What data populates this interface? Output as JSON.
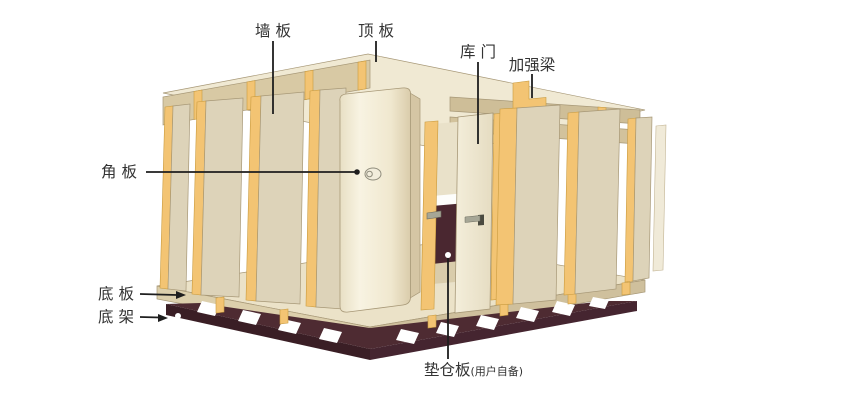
{
  "palette": {
    "background": "#ffffff",
    "panel_face": "#DDD3B9",
    "panel_face_light": "#EFE8D2",
    "panel_edge_yellow": "#F3C473",
    "panel_edge_yellow_dark": "#C99B3F",
    "roof_top": "#F0E9D3",
    "roof_fascia": "#D8C9A4",
    "roof_fascia_right": "#CEBE98",
    "header_rail": "#D2C29C",
    "panel_side_face": "#D5C6A4",
    "slab_top": "#EBE2C8",
    "slab_left_face": "#DCCFAC",
    "slab_right_face": "#CFC09D",
    "frame_dark": "#4E2B32",
    "frame_darker": "#3A1E25",
    "interior_dark": "#4A2730",
    "interior_wall": "#E9E1C9",
    "interior_trim": "#D9CCAB",
    "metal": "#A6A696",
    "leader_line": "#1E1E1E",
    "label_text": "#333333",
    "outline": "#A79877"
  },
  "labels": {
    "wall_panel": "墙 板",
    "top_panel": "顶 板",
    "door": "库 门",
    "reinforcement_beam": "加强梁",
    "corner_panel": "角 板",
    "bottom_panel": "底 板",
    "bottom_frame": "底 架",
    "pallet_board": "垫仓板",
    "pallet_board_note": "(用户自备)"
  }
}
